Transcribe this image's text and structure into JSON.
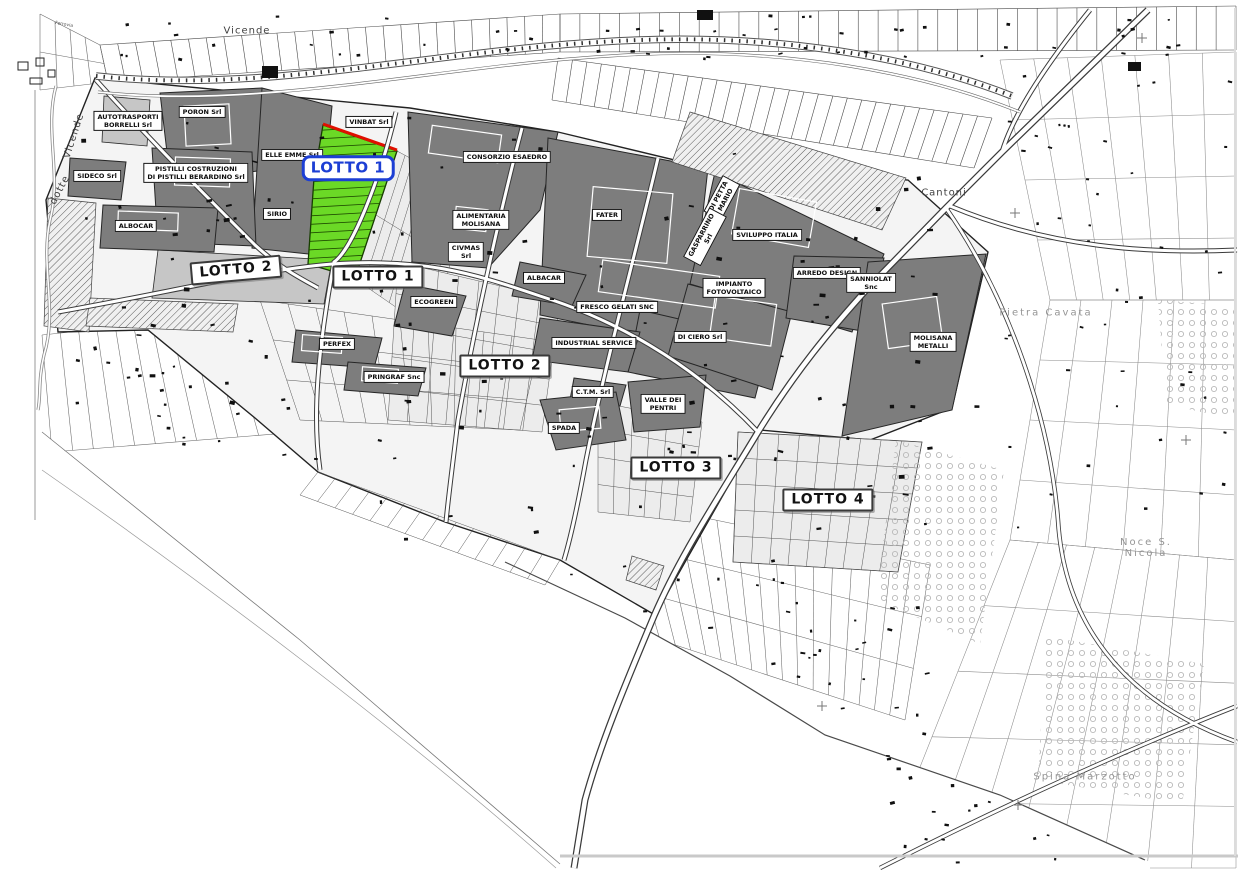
{
  "map": {
    "type": "cadastral-zoning-map",
    "colors": {
      "background": "#ffffff",
      "parcel_dark": "#7d7d7d",
      "parcel_mid": "#c6c6c6",
      "parcel_light": "#ececec",
      "zone_base": "#f4f4f4",
      "highlight_green": "#6bd926",
      "highlight_red_edge": "#e01000",
      "lotto_label_blue": "#1d3fd4",
      "line_dark": "#2b2b2b"
    },
    "highlight_parcel": {
      "name": "LOTTO 1",
      "fill": "#6bd926"
    },
    "company_labels": [
      {
        "id": "autotrasporti-borrelli",
        "text": "AUTOTRASPORTI\nBORRELLI Srl",
        "x": 128,
        "y": 121
      },
      {
        "id": "poron",
        "text": "PORON Srl",
        "x": 202,
        "y": 112
      },
      {
        "id": "elle-emme",
        "text": "ELLE EMME Srl",
        "x": 292,
        "y": 155
      },
      {
        "id": "vinbat",
        "text": "VINBAT Srl",
        "x": 369,
        "y": 122
      },
      {
        "id": "sideco",
        "text": "SIDECO Srl",
        "x": 97,
        "y": 176
      },
      {
        "id": "pistilli-costruzioni",
        "text": "PISTILLI COSTRUZIONI\nDI PISTILLI BERARDINO Srl",
        "x": 196,
        "y": 173
      },
      {
        "id": "sirio",
        "text": "SIRIO",
        "x": 277,
        "y": 214
      },
      {
        "id": "albocar",
        "text": "ALBOCAR",
        "x": 136,
        "y": 226
      },
      {
        "id": "consorzio-esaedro",
        "text": "CONSORZIO ESAEDRO",
        "x": 507,
        "y": 157
      },
      {
        "id": "alimentaria-molisana",
        "text": "ALIMENTARIA\nMOLISANA",
        "x": 481,
        "y": 220
      },
      {
        "id": "civmas",
        "text": "CIVMAS\nSrl",
        "x": 466,
        "y": 252
      },
      {
        "id": "fater",
        "text": "FATER",
        "x": 607,
        "y": 215
      },
      {
        "id": "sviluppo-italia",
        "text": "SVILUPPO ITALIA",
        "x": 767,
        "y": 235
      },
      {
        "id": "albacar",
        "text": "ALBACAR",
        "x": 544,
        "y": 278
      },
      {
        "id": "ecogreen",
        "text": "ECOGREEN",
        "x": 434,
        "y": 302
      },
      {
        "id": "fresco-gelati",
        "text": "FRESCO GELATI SNC",
        "x": 617,
        "y": 307
      },
      {
        "id": "impianto-fotovoltaico",
        "text": "IMPIANTO\nFOTOVOLTAICO",
        "x": 734,
        "y": 288
      },
      {
        "id": "arredo-design",
        "text": "ARREDO DESIGN",
        "x": 827,
        "y": 273
      },
      {
        "id": "sanniolat",
        "text": "SANNIOLAT\nSnc",
        "x": 871,
        "y": 283
      },
      {
        "id": "perfex",
        "text": "PERFEX",
        "x": 337,
        "y": 344
      },
      {
        "id": "industrial-service",
        "text": "INDUSTRIAL SERVICE",
        "x": 594,
        "y": 343
      },
      {
        "id": "di-ciero",
        "text": "DI CIERO Srl",
        "x": 700,
        "y": 337
      },
      {
        "id": "molisana-metalli",
        "text": "MOLISANA\nMETALLI",
        "x": 933,
        "y": 342
      },
      {
        "id": "pringraf",
        "text": "PRINGRAF Snc",
        "x": 394,
        "y": 377
      },
      {
        "id": "ctm",
        "text": "C.T.M. Srl",
        "x": 593,
        "y": 392
      },
      {
        "id": "valle-dei-pentri",
        "text": "VALLE DEI\nPENTRI",
        "x": 663,
        "y": 404
      },
      {
        "id": "spada",
        "text": "SPADA",
        "x": 564,
        "y": 428
      },
      {
        "id": "di-petta-mario",
        "text": "DI PETTA\nMARIO",
        "x": 722,
        "y": 198,
        "rot": -62
      },
      {
        "id": "gasparrino",
        "text": "GASPARRINO\nSrl",
        "x": 705,
        "y": 237,
        "rot": -62
      }
    ],
    "lot_labels": [
      {
        "id": "lotto1-highlight",
        "text": "LOTTO 1",
        "x": 348,
        "y": 168,
        "variant": "highlight"
      },
      {
        "id": "lotto2-west",
        "text": "LOTTO 2",
        "x": 236,
        "y": 270,
        "variant": "lotto",
        "rot": -5
      },
      {
        "id": "lotto1-box",
        "text": "LOTTO 1",
        "x": 378,
        "y": 277,
        "variant": "lotto"
      },
      {
        "id": "lotto2-box",
        "text": "LOTTO 2",
        "x": 505,
        "y": 366,
        "variant": "lotto"
      },
      {
        "id": "lotto3-box",
        "text": "LOTTO 3",
        "x": 676,
        "y": 468,
        "variant": "lotto"
      },
      {
        "id": "lotto4-box",
        "text": "LOTTO 4",
        "x": 828,
        "y": 500,
        "variant": "lotto"
      }
    ],
    "place_labels": [
      {
        "id": "vicende-top",
        "text": "Vicende",
        "x": 247,
        "y": 31,
        "tone": "dark"
      },
      {
        "id": "vicende-river",
        "text": "Vicende",
        "x": 74,
        "y": 136,
        "rot": -72,
        "tone": "dark"
      },
      {
        "id": "dotte",
        "text": "dotte",
        "x": 60,
        "y": 190,
        "rot": -62,
        "tone": "dark"
      },
      {
        "id": "cantoni",
        "text": "Cantoni",
        "x": 944,
        "y": 193,
        "tone": "dark"
      },
      {
        "id": "pietra-cavata",
        "text": "Pietra Cavata",
        "x": 1046,
        "y": 313,
        "tone": "light"
      },
      {
        "id": "noce-s-nicola",
        "text": "Noce  S. Nicola",
        "x": 1146,
        "y": 548,
        "tone": "light"
      },
      {
        "id": "spina-marzotto",
        "text": "Spina  Marzotto",
        "x": 1085,
        "y": 777,
        "tone": "light"
      },
      {
        "id": "ferrovia",
        "text": "Ferrovia",
        "x": 64,
        "y": 25,
        "rot": 10,
        "tone": "tiny"
      }
    ]
  }
}
